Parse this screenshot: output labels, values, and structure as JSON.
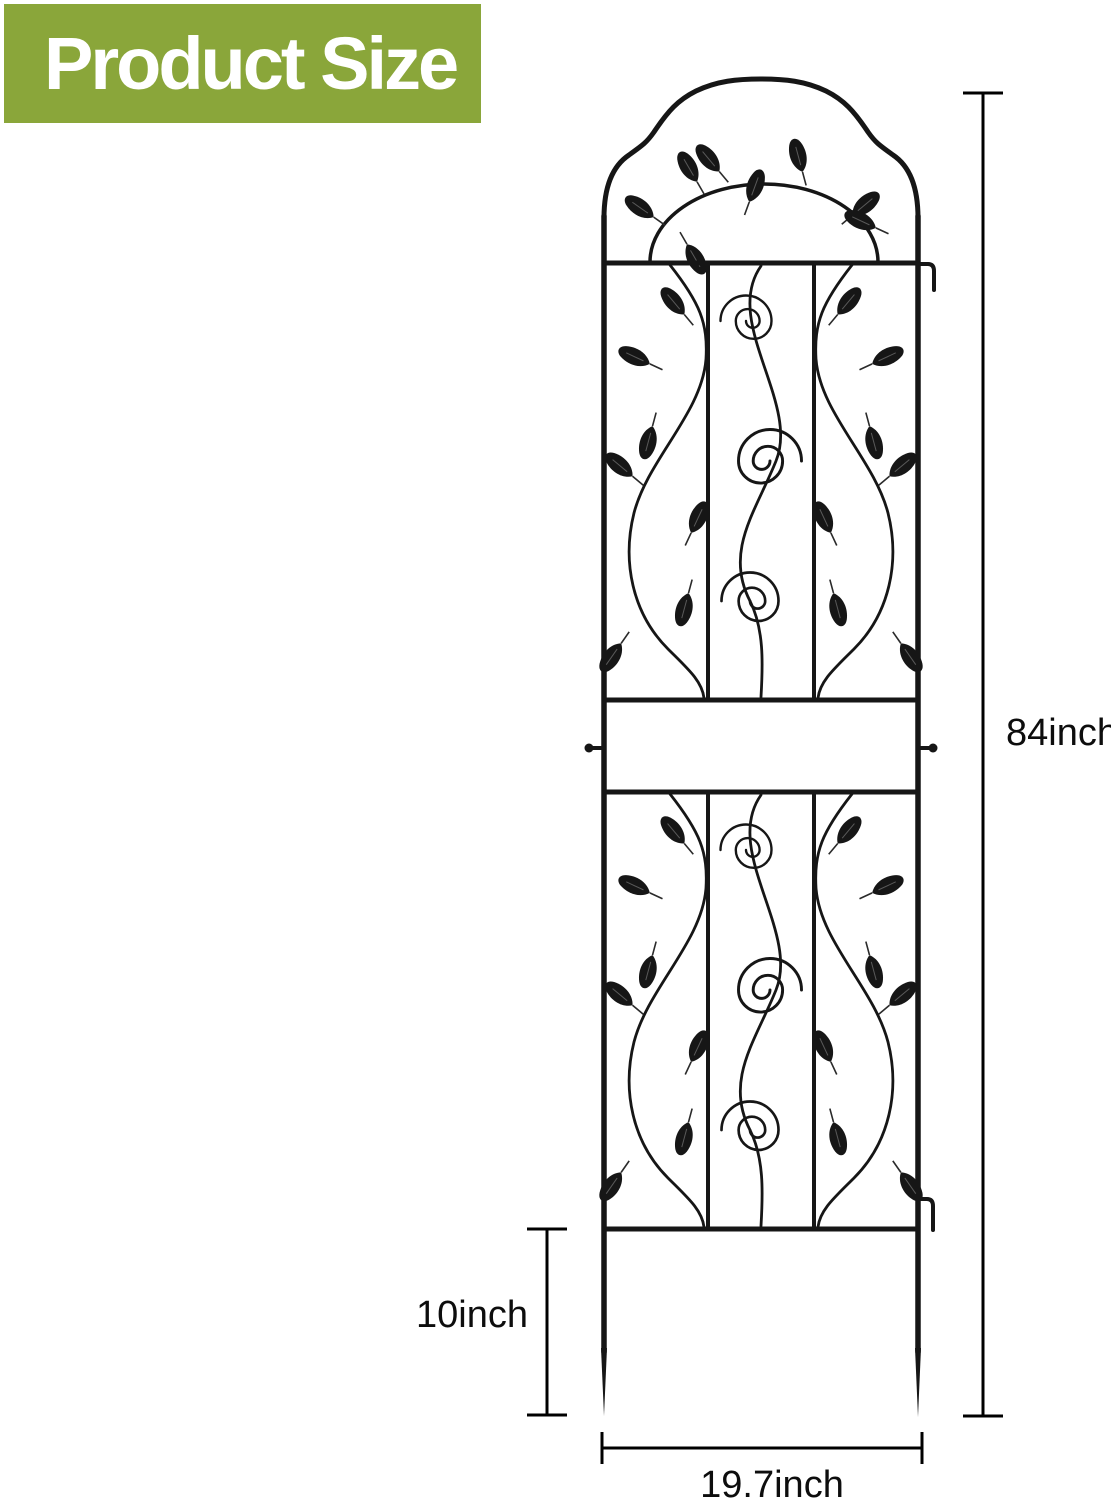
{
  "banner": {
    "title": "Product Size",
    "bg_color": "#8aa63a",
    "text_color": "#ffffff"
  },
  "diagram": {
    "labels": {
      "total_height": "84inch",
      "stake_height": "10inch",
      "width": "19.7inch"
    },
    "colors": {
      "trellis": "#161616",
      "dimension": "#000000"
    }
  }
}
